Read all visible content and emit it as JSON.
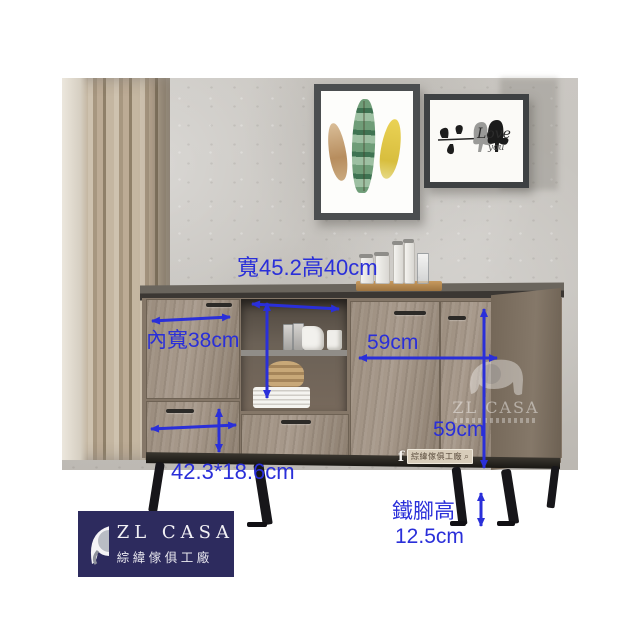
{
  "annotations": {
    "accent_color": "#2a2fd9",
    "top_dim": "寬45.2高40cm",
    "inner_width": "內寬38cm",
    "door_width": "59cm",
    "door_height": "59cm",
    "drawer_dim": "42.3*18.6cm",
    "leg_label": "鐵腳高",
    "leg_height": "12.5cm"
  },
  "frames": {
    "love_line1": "Love",
    "love_line2": "you"
  },
  "watermark": {
    "brand": "ZL CASA"
  },
  "facebook": {
    "icon": "f",
    "page_name": "綜緯傢俱工廠",
    "search_icon": "⌕"
  },
  "logo": {
    "brand": "ZL CASA",
    "company": "綜緯傢俱工廠",
    "bg_color": "#2d2b5e"
  }
}
